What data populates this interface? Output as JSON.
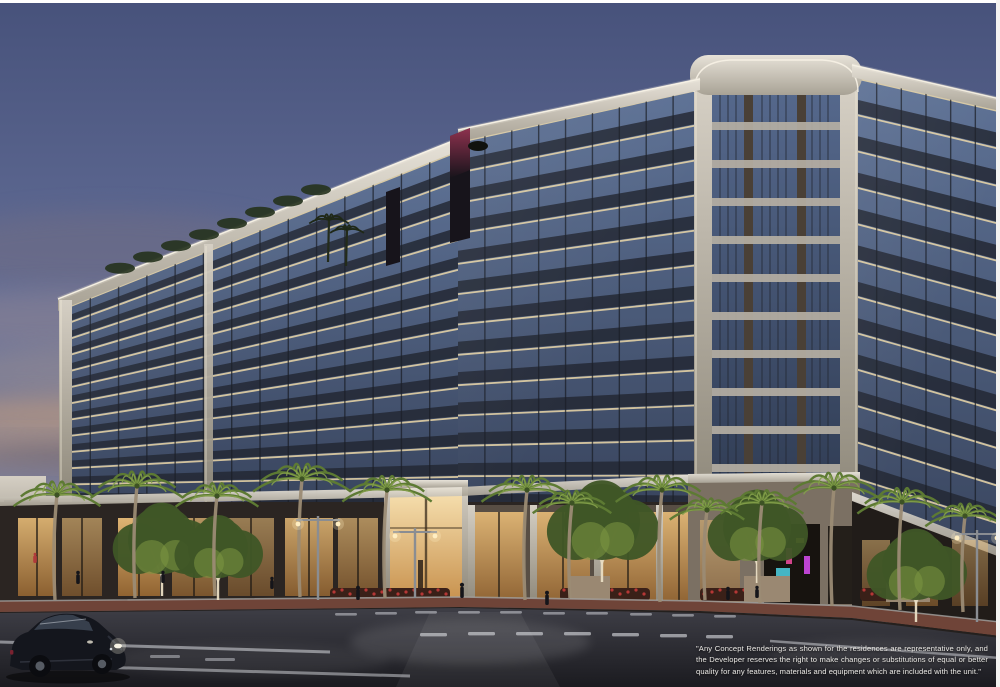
{
  "scene_label": "residential-building-dusk-rendering",
  "disclaimer": {
    "text": "\"Any Concept Renderings as shown for the residences are representative only, and the Developer reserves the right to make changes or substitutions of equal or better quality for any features, materials and equipment which are included with the unit.\""
  },
  "building": {
    "floors_visible": 12,
    "corner_tower_floors": 11
  },
  "palette": {
    "sky_top": "#47527b",
    "sky_mid": "#67729b",
    "cloud_gray": "#8b8292",
    "cloud_warm": "#c89f7c",
    "cloud_dark": "#5e5a6d",
    "glass_light": "#5e7296",
    "glass_dark": "#39455e",
    "slab_dark": "#232834",
    "soffit_warm": "#ecd8a8",
    "cornice": "#d9d4ca",
    "pier_cream": "#c9c3b7",
    "spandrel": "#b5afa3",
    "bronze": "#4a4036",
    "fin_dark": "#17141b",
    "fin_glow": "#a63a5c",
    "tower_glass_top": "#55688c",
    "tower_glass_bottom": "#2f3b52",
    "podium_dark": "#2b2522",
    "store_glow_top": "#f2c47c",
    "store_glow_bottom": "#9c6a33",
    "entrance_glow": "#f7e0b0",
    "sidewalk_brick": "#6f4438",
    "curb": "#a3a3a0",
    "road_top": "#3e3e46",
    "road_bottom": "#1b1b20",
    "marking": "#d8dadf",
    "palm_frond": "#5d7a33",
    "palm_frond_lit": "#84a04a",
    "palm_trunk": "#9b8b74",
    "tree_canopy": "#3f5626",
    "tree_lit": "#7d9841",
    "trunk_lit": "#eadec4",
    "car_body": "#14161d",
    "car_glass": "#39414f",
    "headlight": "#f4f1e4",
    "far_building": "#d5cfc5"
  }
}
